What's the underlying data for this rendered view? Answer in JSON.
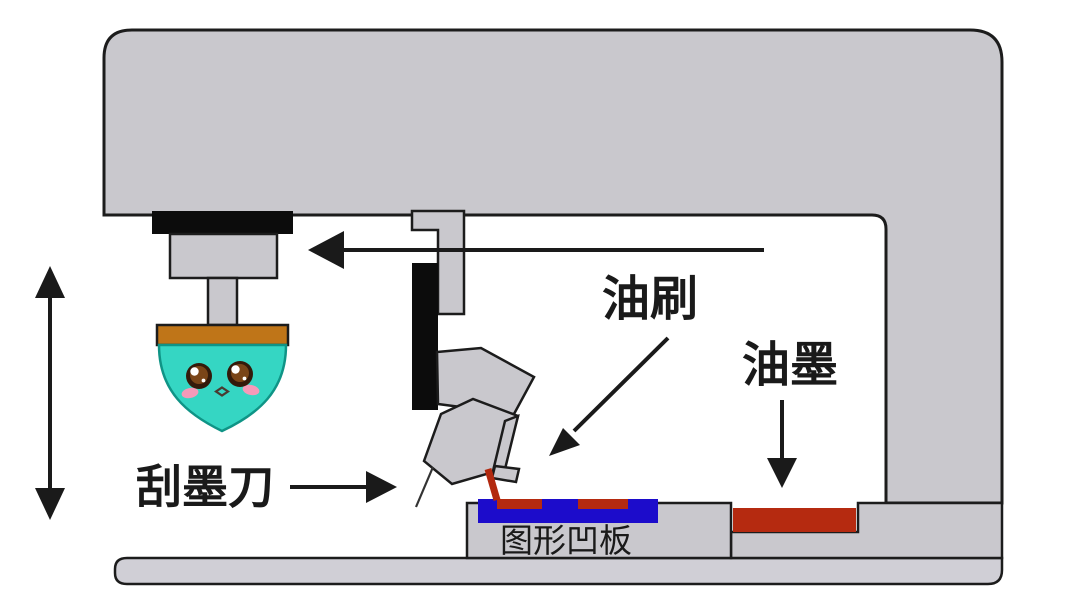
{
  "labels": {
    "scraper_blade": "刮墨刀",
    "ink_brush": "油刷",
    "ink": "油墨",
    "pattern_plate": "图形凹板"
  },
  "colors": {
    "pad_teal": "#35d6c3",
    "pad_edge": "#0f9486",
    "cap_orange": "#bf7518",
    "ink_red": "#b52a10",
    "plate_blue": "#1c0ccb",
    "machine_gray": "#c9c8cd",
    "outline_black": "#1a1a1a",
    "blush_pink": "#f59ab9",
    "eye_dark_brown": "#331a0a",
    "eye_brown": "#7a4518"
  }
}
